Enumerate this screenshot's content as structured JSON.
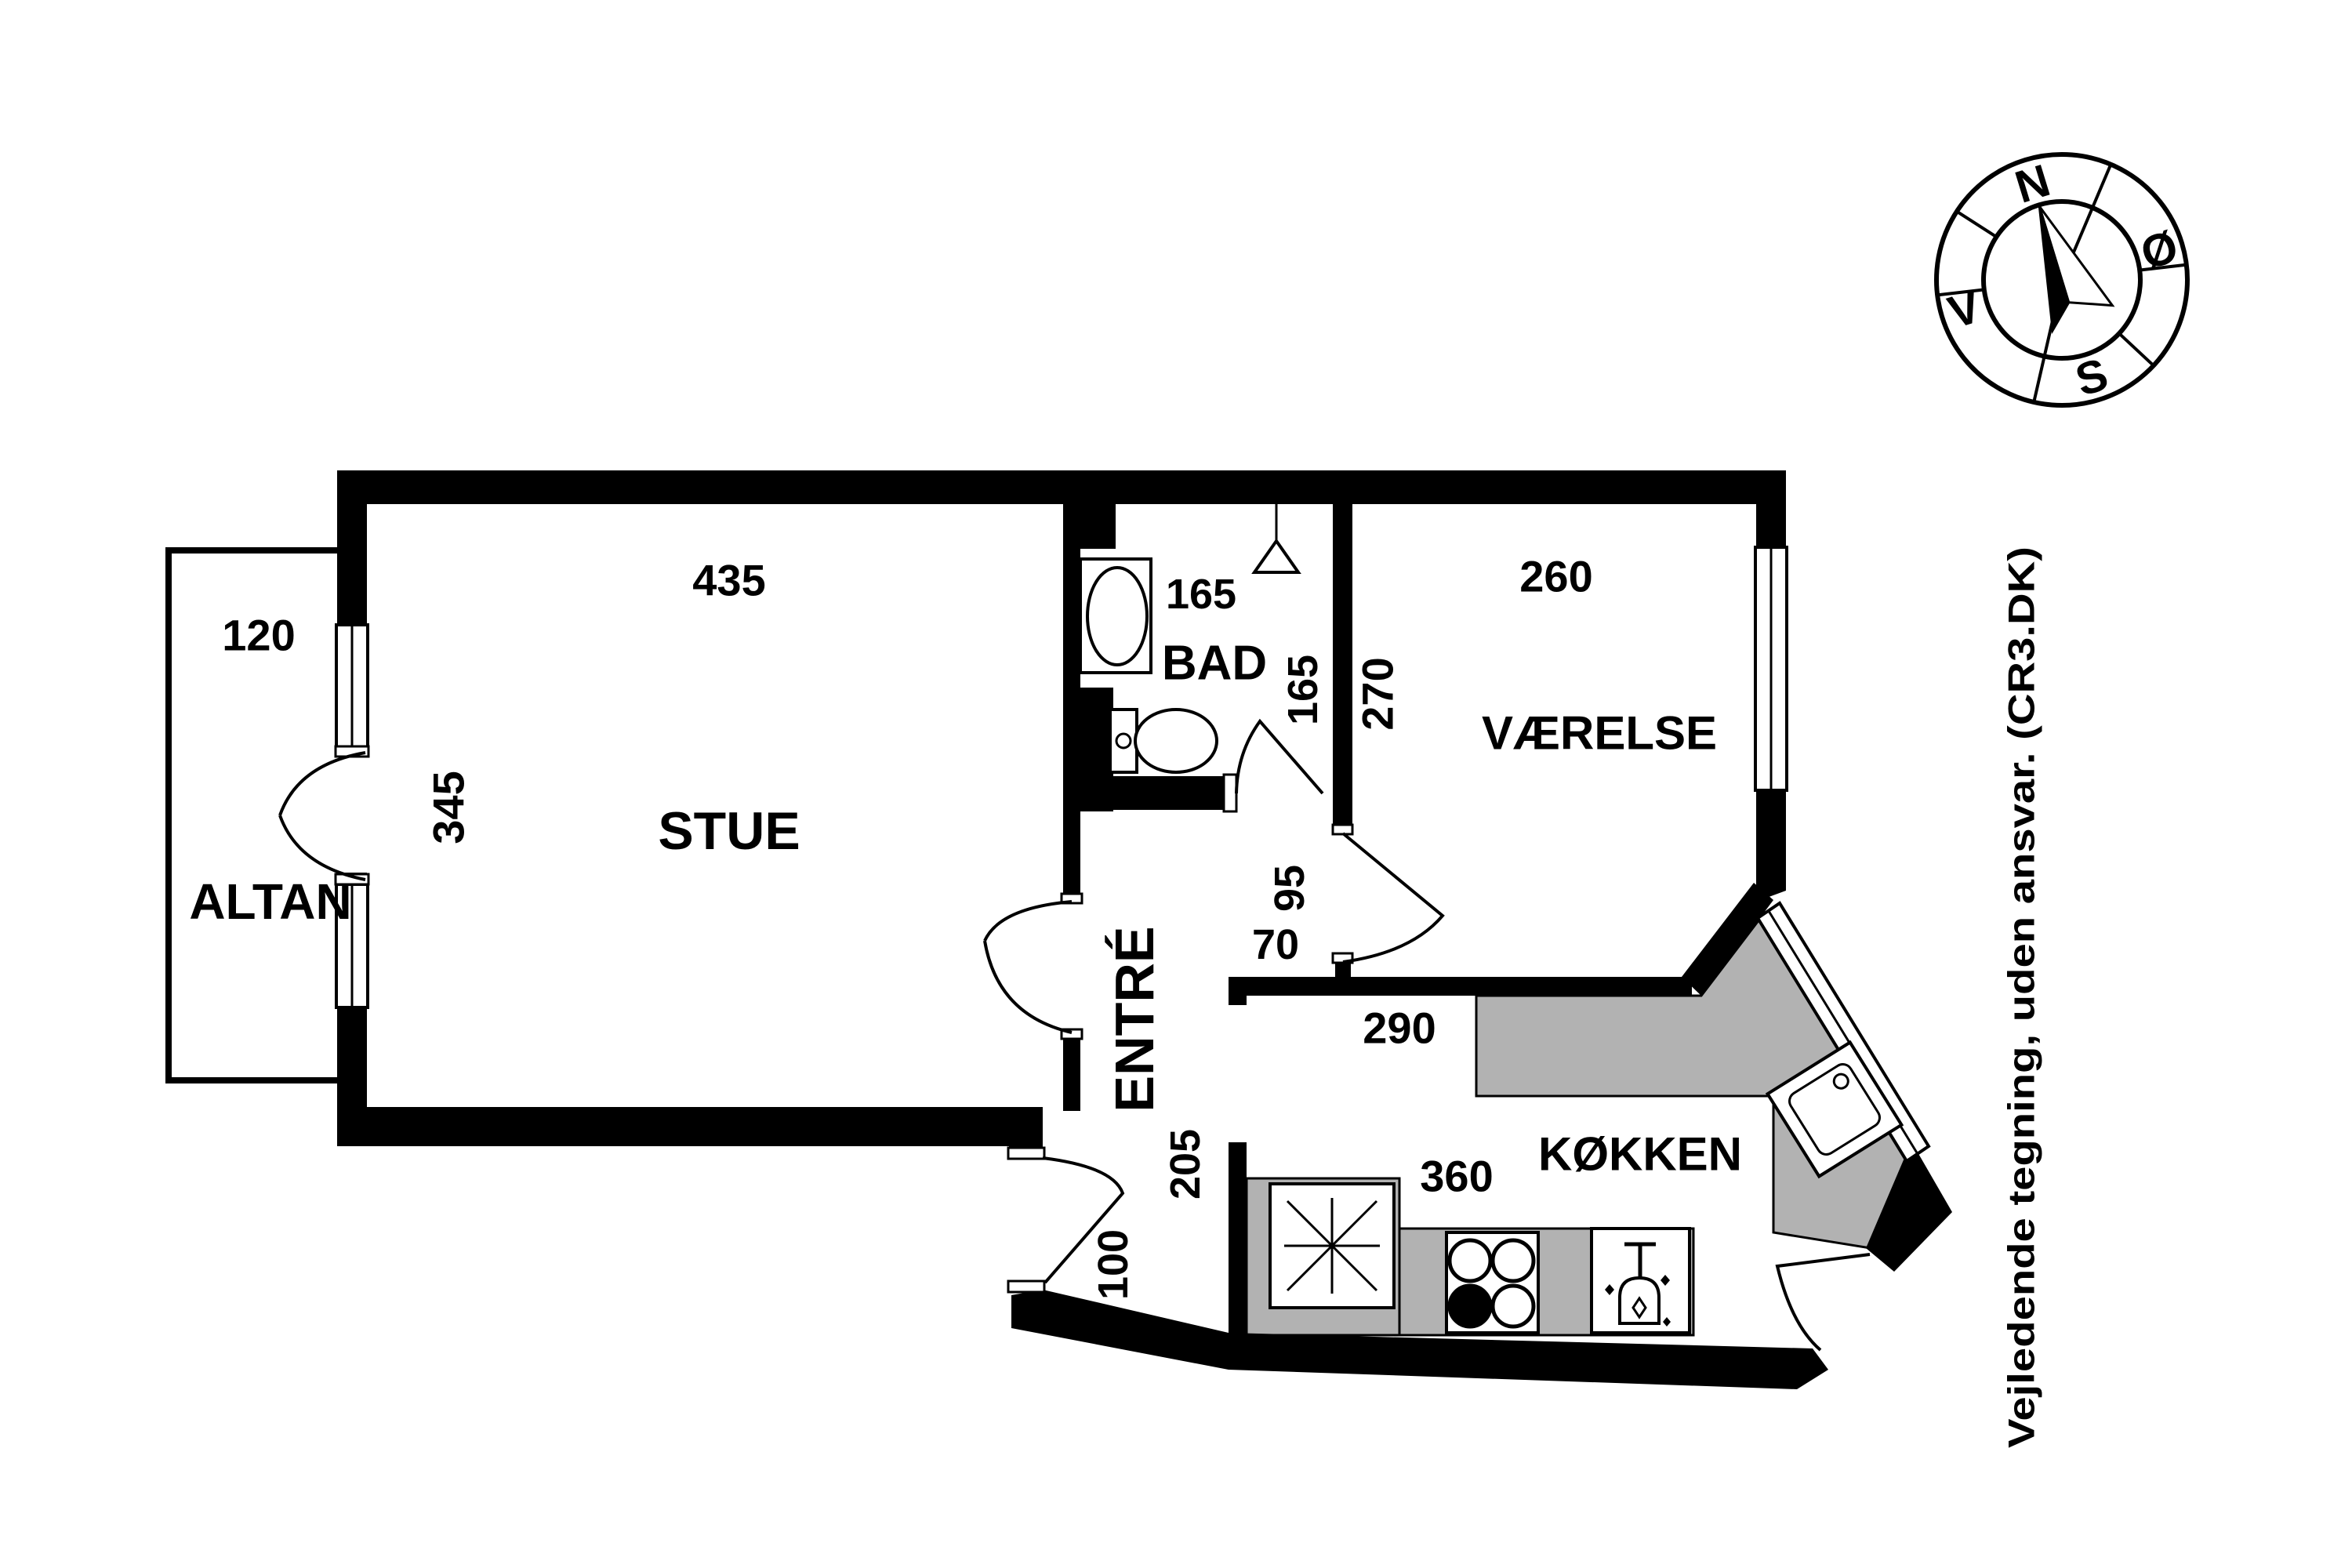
{
  "page": {
    "background": "#ffffff",
    "ink": "#000000",
    "counter_gray": "#b2b2b2"
  },
  "disclaimer": "Vejledende tegning, uden ansvar. (CR3.DK)",
  "compass": {
    "north": "N",
    "east": "Ø",
    "south": "S",
    "west": "V"
  },
  "rooms": {
    "altan": "ALTAN",
    "stue": "STUE",
    "bad": "BAD",
    "vaerelse": "VÆRELSE",
    "entre": "ENTRÉ",
    "koekken": "KØKKEN"
  },
  "dimensions": {
    "altan_depth": "120",
    "stue_width": "435",
    "stue_height": "345",
    "bad_width": "165",
    "bad_height": "165",
    "vaerelse_width": "260",
    "vaerelse_height": "270",
    "entre_nook_width": "95",
    "entre_nook_offset": "70",
    "entre_height": "205",
    "entre_width": "100",
    "koekken_top_width": "290",
    "koekken_bottom_width": "360"
  }
}
